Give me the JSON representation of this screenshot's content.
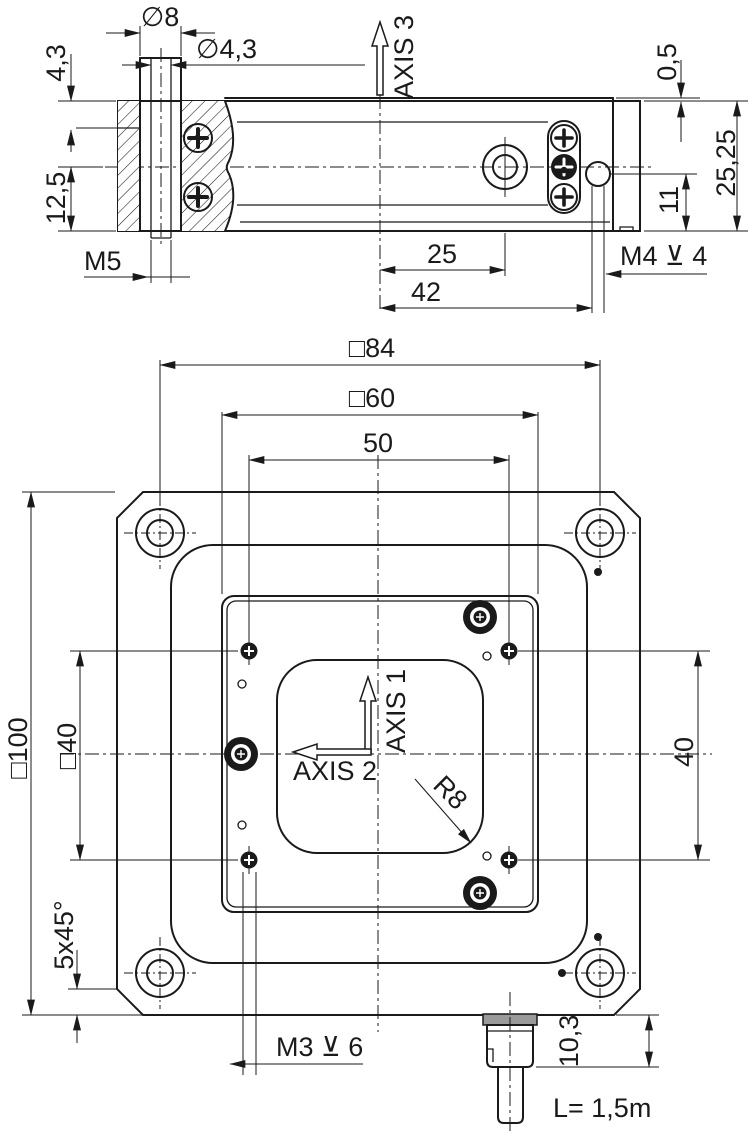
{
  "drawing_title": "positioning-stage-dimension-drawing",
  "colors": {
    "line": "#1a1a1a",
    "background": "#ffffff",
    "connector_flange": "#9a9a9a"
  },
  "side_view": {
    "labels": {
      "dia8": "∅8",
      "dia43": "∅4,3",
      "height43": "4,3",
      "height125": "12,5",
      "m5": "M5",
      "axis3": "AXIS 3",
      "step05": "0,5",
      "height2525": "25,25",
      "height11": "11",
      "width25": "25",
      "width42": "42",
      "m4_depth": "M4 ⊻ 4"
    }
  },
  "plan_view": {
    "labels": {
      "sq84": "□84",
      "sq60": "□60",
      "width50": "50",
      "sq100": "□100",
      "sq40": "□40",
      "height40": "40",
      "axis1": "AXIS 1",
      "axis2": "AXIS 2",
      "r8": "R8",
      "chamfer": "5x45°",
      "m3_depth": "M3 ⊻ 6",
      "height103": "10,3",
      "cable_length": "L= 1,5m"
    }
  }
}
